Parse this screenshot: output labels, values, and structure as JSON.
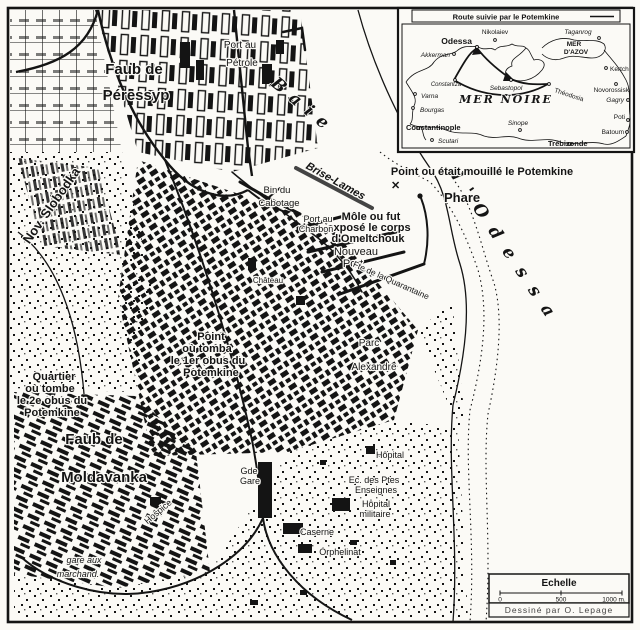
{
  "map": {
    "suburbs": {
      "peressyp_1": "Faub de",
      "peressyp_2": "Péressyp",
      "moldavanka_1": "Faub de",
      "moldavanka_2": "Moldavanka",
      "slobodka": "Nov. Slobodka"
    },
    "water": {
      "bay_1": "Baie",
      "bay_2": "d'Odessa"
    },
    "port": {
      "brise_lames": "Brise-Lames",
      "petrole_1": "Port au",
      "petrole_2": "Pétrole",
      "cabotage_1": "Bin du",
      "cabotage_2": "Cabotage",
      "charbon_1": "Port au",
      "charbon_2": "Charbon",
      "nouveau_1": "Nouveau",
      "nouveau_2": "Port",
      "quarantaine": "Fte de la Quarantaine",
      "phare": "Phare"
    },
    "events": {
      "mouillage": "Point ou était mouillé le Potemkine",
      "mouillage_marker": "✕",
      "mole_1": "Môle ou fut",
      "mole_2": "exposé le corps",
      "mole_3": "d'Omeltchouk",
      "obus1_1": "Point",
      "obus1_2": "où tomba",
      "obus1_3": "le 1er obus du",
      "obus1_4": "Potemkine",
      "obus2_1": "Quartier",
      "obus2_2": "où tombe",
      "obus2_3": "le 2e obus du",
      "obus2_4": "Potemkine"
    },
    "places": {
      "parc_1": "Parc",
      "parc_2": "Alexandre",
      "chateau": "Château",
      "hopital": "Hôpital",
      "enseignes_1": "Ec. des Ptes",
      "enseignes_2": "Enseignes",
      "hopital_mil_1": "Hôpital",
      "hopital_mil_2": "militaire",
      "caserne": "Caserne",
      "orphelinat": "Orphelinat",
      "gare_1": "Gde",
      "gare_2": "Gare",
      "hospice": "Hospice",
      "marchand_1": "gare aux",
      "marchand_2": "marchand."
    }
  },
  "inset": {
    "title": "Route suivie par le Potemkine",
    "seas": {
      "azov_1": "MER",
      "azov_2": "D'AZOV",
      "noire": "MER NOIRE"
    },
    "places": {
      "odessa": "Odessa",
      "nikolaiev": "Nikolaiev",
      "taganrog": "Taganrog",
      "akkerman": "Akkerman",
      "kertch": "Kertch",
      "novorossisk": "Novorossisk",
      "constantza": "Constantza",
      "sebastopol": "Sebastopol",
      "theodosia": "Théodosia",
      "varna": "Varna",
      "bourgas": "Bourgas",
      "gagry": "Gagry",
      "sinope": "Sinope",
      "poti": "Poti",
      "batoum": "Batoum",
      "constantinople": "Constantinople",
      "scutari": "Scutari",
      "trebizonde": "Trébizonde"
    }
  },
  "scale": {
    "title": "Echelle",
    "tick_0": "0",
    "tick_500": "500",
    "tick_1000": "1000 m."
  },
  "credit": "Dessiné par O. Lepage",
  "colors": {
    "ink": "#141414",
    "paper": "#fbfaf6"
  }
}
